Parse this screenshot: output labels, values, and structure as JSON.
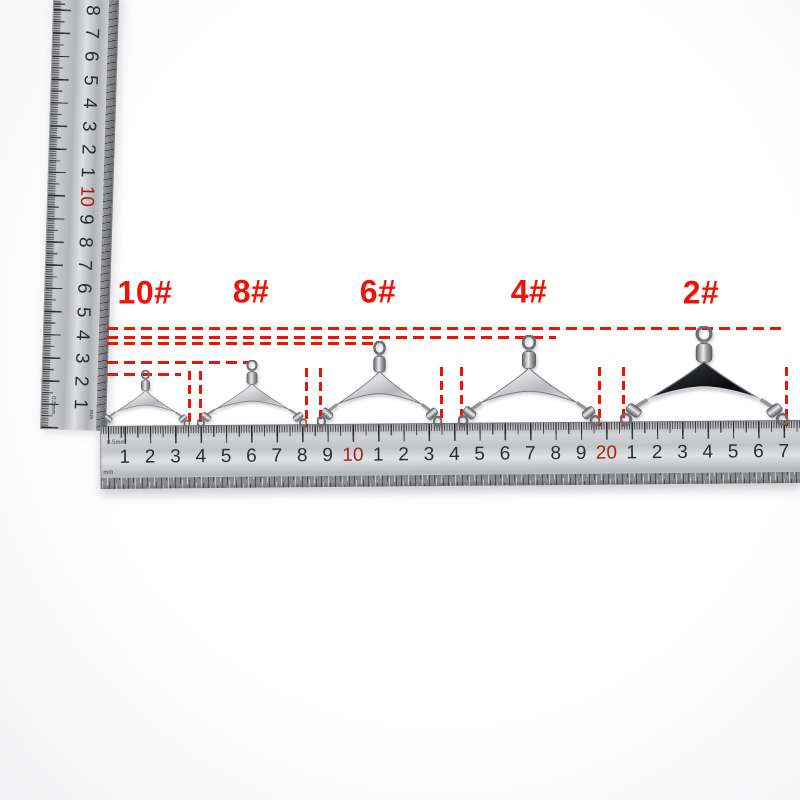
{
  "scene": {
    "accent_red": "#ee1306",
    "ruler_number_color": "#2c2d31",
    "ruler_red_number_color": "#9e2418",
    "background_tint": "#f2f2f4"
  },
  "size_labels": [
    {
      "text": "10#",
      "x": 145,
      "y": 293
    },
    {
      "text": "8#",
      "x": 251,
      "y": 292
    },
    {
      "text": "6#",
      "x": 378,
      "y": 292
    },
    {
      "text": "4#",
      "x": 529,
      "y": 292
    },
    {
      "text": "2#",
      "x": 701,
      "y": 293
    }
  ],
  "items": [
    {
      "label": "10#",
      "left": 101,
      "top": 370,
      "width": 89,
      "height": 58,
      "dark": false
    },
    {
      "label": "8#",
      "left": 197,
      "top": 360,
      "width": 110,
      "height": 68,
      "dark": false
    },
    {
      "label": "6#",
      "left": 317,
      "top": 341,
      "width": 125,
      "height": 87,
      "dark": false
    },
    {
      "label": "4#",
      "left": 458,
      "top": 335,
      "width": 142,
      "height": 93,
      "dark": false
    },
    {
      "label": "2#",
      "left": 620,
      "top": 326,
      "width": 168,
      "height": 101,
      "dark": true
    }
  ],
  "guides": {
    "horizontal": [
      {
        "y": 327,
        "x1": 107,
        "x2": 786
      },
      {
        "y": 336,
        "x1": 107,
        "x2": 556
      },
      {
        "y": 342,
        "x1": 107,
        "x2": 377
      },
      {
        "y": 361,
        "x1": 107,
        "x2": 249
      },
      {
        "y": 373,
        "x1": 107,
        "x2": 181
      }
    ],
    "vertical": [
      {
        "x": 188,
        "y1": 371,
        "y2": 426
      },
      {
        "x": 199,
        "y1": 371,
        "y2": 426
      },
      {
        "x": 305,
        "y1": 368,
        "y2": 427
      },
      {
        "x": 319,
        "y1": 368,
        "y2": 427
      },
      {
        "x": 440,
        "y1": 367,
        "y2": 424
      },
      {
        "x": 460,
        "y1": 367,
        "y2": 424
      },
      {
        "x": 598,
        "y1": 367,
        "y2": 426
      },
      {
        "x": 622,
        "y1": 367,
        "y2": 426
      },
      {
        "x": 785,
        "y1": 367,
        "y2": 426
      }
    ]
  },
  "vertical_ruler": {
    "numbers": [
      "8",
      "7",
      "6",
      "5",
      "4",
      "3",
      "2",
      "1",
      "10",
      "9",
      "8",
      "7",
      "6",
      "5",
      "4",
      "3",
      "2",
      "1"
    ],
    "red_indices": [
      8
    ],
    "number_start": 15,
    "number_step": 23.2,
    "graduation_label": "0.5mm",
    "unit_label": "mm"
  },
  "horizontal_ruler": {
    "numbers": [
      "1",
      "2",
      "3",
      "4",
      "5",
      "6",
      "7",
      "8",
      "9",
      "10",
      "1",
      "2",
      "3",
      "4",
      "5",
      "6",
      "7",
      "8",
      "9",
      "20",
      "1",
      "2",
      "3",
      "4",
      "5",
      "6",
      "7"
    ],
    "red_indices": [
      9,
      19
    ],
    "number_start": 23.5,
    "number_step": 25.35,
    "graduation_label": "0.5mm",
    "unit_label": "mm"
  }
}
